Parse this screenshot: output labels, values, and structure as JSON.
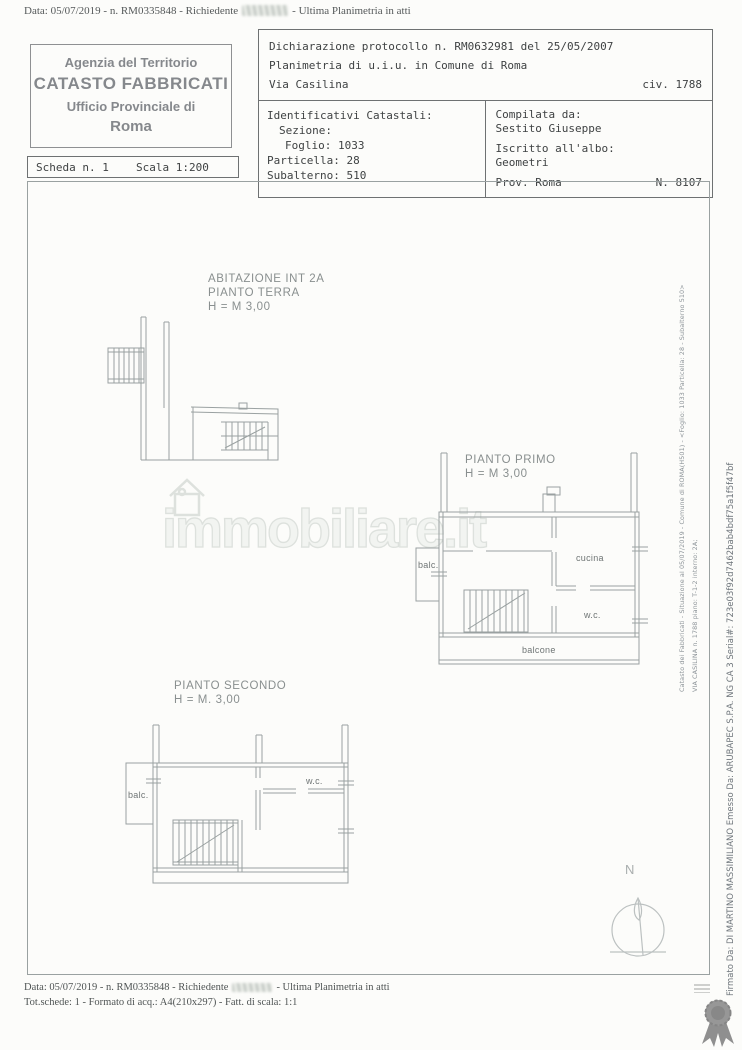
{
  "document": {
    "top_line": {
      "prefix": "Data: 05/07/2019 - n. RM0335848 - Richiedente",
      "suffix": "- Ultima Planimetria in atti"
    },
    "agency_box": {
      "line1": "Agenzia del Territorio",
      "line2": "CATASTO FABBRICATI",
      "line3": "Ufficio Provinciale di",
      "line4": "Roma"
    },
    "declaration": {
      "protocol": "Dichiarazione protocollo n. RM0632981 del 25/05/2007",
      "planimetria": "Planimetria di u.i.u. in Comune di Roma",
      "street": "Via Casilina",
      "civic": "civ. 1788"
    },
    "identifiers": {
      "title": "Identificativi Catastali:",
      "sezione": "Sezione:",
      "foglio": "Foglio: 1033",
      "particella": "Particella: 28",
      "subalterno": "Subalterno: 510"
    },
    "compiler": {
      "label": "Compilata da:",
      "name": "Sestito Giuseppe",
      "albo_label": "Iscritto all'albo:",
      "albo": "Geometri",
      "prov": "Prov. Roma",
      "number": "N. 8107"
    },
    "scheda": {
      "sheet": "Scheda n. 1",
      "scale": "Scala 1:200"
    },
    "plans": {
      "terra": {
        "line1": "ABITAZIONE INT 2A",
        "line2": "PIANTO TERRA",
        "line3": "H = M 3,00"
      },
      "primo": {
        "line1": "PIANTO PRIMO",
        "line2": "H = M 3,00",
        "rooms": {
          "balc": "balc.",
          "cucina": "cucina",
          "wc": "w.c.",
          "balcone": "balcone"
        }
      },
      "secondo": {
        "line1": "PIANTO SECONDO",
        "line2": "H = M. 3,00",
        "rooms": {
          "balc": "balc.",
          "wc": "w.c."
        }
      }
    },
    "watermark": "immobiliare.it",
    "compass_label": "N",
    "side_text": {
      "cadastral": "Catasto dei Fabbricati - Situazione al 05/07/2019 - Comune di ROMA(H501) - <Foglio: 1033 Particella: 28 - Subalterno 510>",
      "address": "VIA CASILINA n. 1788 piano: T-1-2 interno: 2A;",
      "signature": "Firmato Da: DI MARTINO MASSIMILIANO Emesso Da: ARUBAPEC S.P.A. NG CA 3 Serial#: 723e03f92d7462bab4bdf75a1f5f47bf"
    },
    "footer": {
      "line1_prefix": "Data: 05/07/2019 - n. RM0335848 - Richiedente",
      "line1_suffix": "- Ultima Planimetria in atti",
      "line2": "Tot.schede: 1 - Formato di acq.: A4(210x297) - Fatt. di scala: 1:1"
    },
    "colors": {
      "paper": "#fcfcfa",
      "ink": "#3f4243",
      "faded_ink": "#85888c",
      "plan_line": "#9aa1a1",
      "watermark": "#dde1dd",
      "badge": "#979797"
    }
  }
}
